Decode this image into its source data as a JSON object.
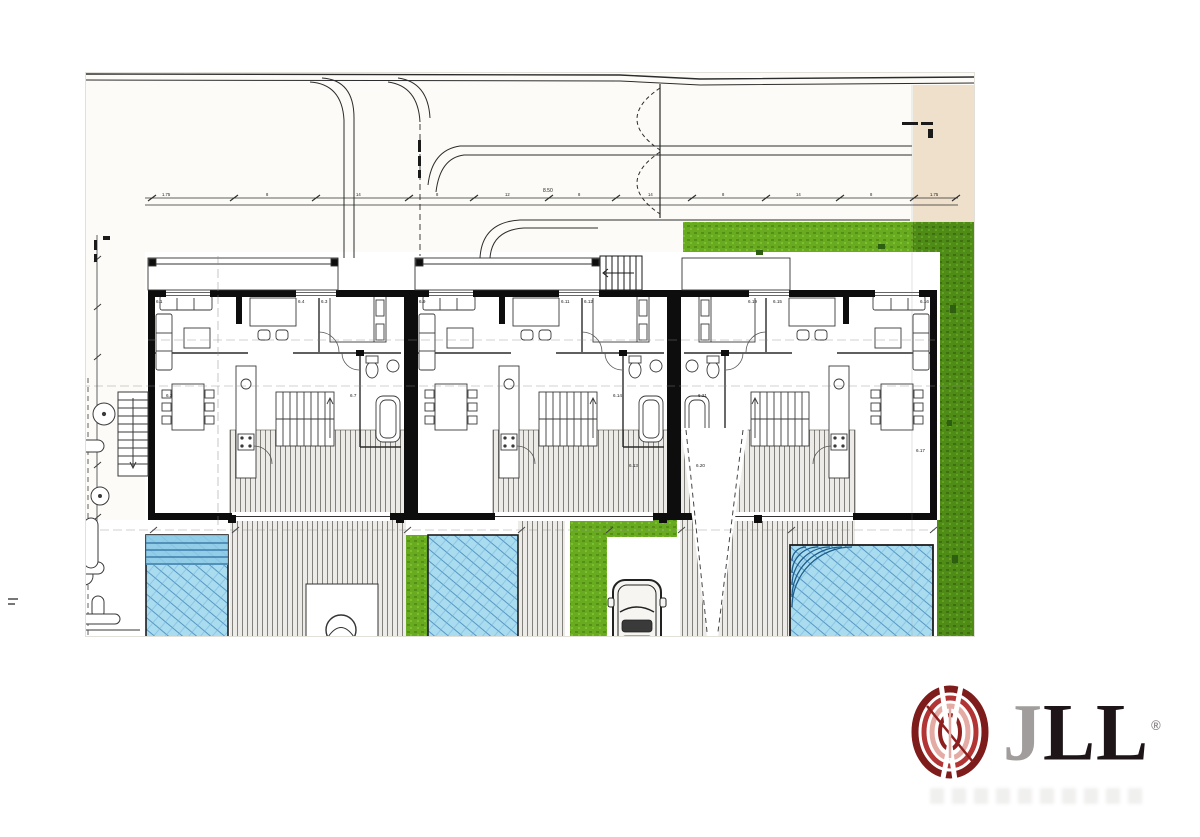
{
  "document": {
    "kind": "scanned architectural site / floor plan, three attached villas with pools",
    "scan_marks": {
      "beige_strip_note": "(illegible small text)",
      "path_vertical_note": "(illegible small text)",
      "left_edge_vertical_note": "(illegible small text)",
      "left_margin_mark": "(illegible)"
    }
  },
  "plan": {
    "room_labels": {
      "unit1": [
        "6.1",
        "6.4",
        "6.3",
        "6.7",
        "6.2"
      ],
      "unit2": [
        "6.9",
        "6.11",
        "6.12",
        "6.14",
        "6.13"
      ],
      "unit3": [
        "6.19",
        "6.15",
        "6.16",
        "6.21",
        "6.20"
      ],
      "extra": "6.17"
    },
    "dimension_line": {
      "total": "8.50",
      "ticks": [
        "1.75",
        "8",
        "14",
        "8",
        "12",
        "8",
        "14",
        "8",
        "14",
        "8",
        "1.75"
      ]
    }
  },
  "colors": {
    "grass_bright": "#68aa20",
    "grass_dark": "#4f8c17",
    "pool_fill": "#aadcf0",
    "pool_steps": "#8ecbe6",
    "pool_line": "#3f85b8",
    "deck_paper": "#ecebe7",
    "deck_line": "#77756f",
    "paper": "#fcfbf7",
    "beige_strip": "#eee0cb",
    "wall": "#0d0d0d",
    "logo_red_dark": "#7e1b1b",
    "logo_red": "#b23434",
    "logo_pink": "#e4aaa4",
    "logo_letter_dark": "#1d1518",
    "logo_letter_gray": "#a19d9d"
  },
  "logo": {
    "j": "J",
    "ll": "LL",
    "registered": "®"
  }
}
